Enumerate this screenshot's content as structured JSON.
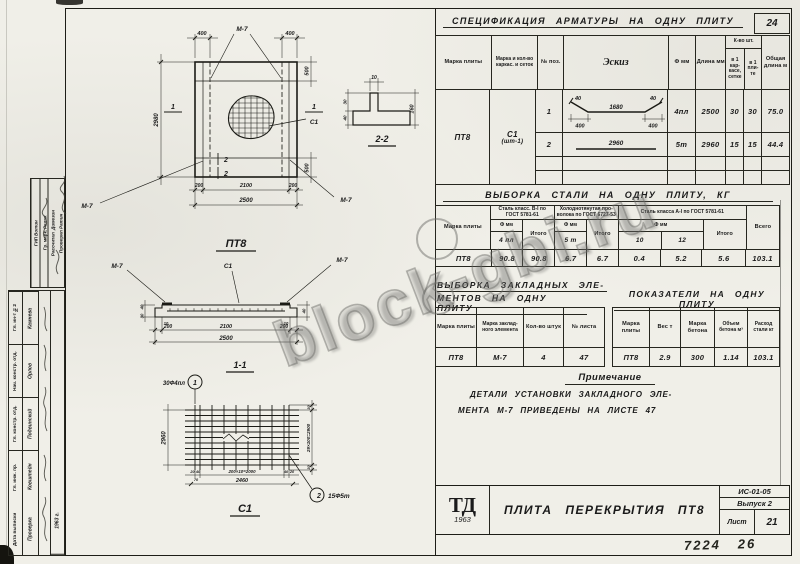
{
  "wm": "block-gbi.ru",
  "stamp": {
    "upper_cols": [
      {
        "label": "ГИП",
        "name": "Вотин"
      },
      {
        "label": "Гр. марк.",
        "name": "Релик"
      },
      {
        "label": "Рассчитал",
        "name": "Димезин"
      },
      {
        "label": "Проверил",
        "name": "Ратин"
      }
    ],
    "lower_labels": [
      "Гл. ин-т №2",
      "Нач. констр. отд.",
      "Гл. констр. отд.",
      "Гл. инж. пр.",
      "Дата выписки"
    ],
    "lower_names": [
      "Камнева",
      "Орлов",
      "Подвинский",
      "Ковштейн",
      "Проверка"
    ],
    "year": "1963 г."
  },
  "spec": {
    "title": "СПЕЦИФИКАЦИЯ  АРМАТУРЫ  НА  ОДНУ  ПЛИТУ",
    "corner": "24",
    "h_marka": "Марка плиты",
    "h_karkas": "Марка и кол-во каркас. и сеток",
    "h_poz": "№ поз.",
    "h_eskiz": "Эскиз",
    "h_f": "Ф мм",
    "h_dlina": "Длина мм",
    "h_kvo": "К-во шт.",
    "h_kvo1": "в 1 кар-касе, сетке",
    "h_kvo2": "в 1 пли-те",
    "h_total": "Общая длина м",
    "marka": "ПТ8",
    "karkas_line1": "С1",
    "karkas_line2": "(шт-1)",
    "rows": [
      {
        "poz": "1",
        "f": "4пл",
        "dlina": "2500",
        "in_karkas": "30",
        "in_plita": "30",
        "total": "75.0",
        "hook_l": "40",
        "hook_r": "40",
        "mid": "1680",
        "seg_l": "400",
        "seg_r": "400"
      },
      {
        "poz": "2",
        "f": "5т",
        "dlina": "2960",
        "in_karkas": "15",
        "in_plita": "15",
        "total": "44.4",
        "len": "2960"
      }
    ]
  },
  "steel": {
    "title": "ВЫБОРКА  СТАЛИ  НА  ОДНУ  ПЛИТУ,  КГ",
    "h_marka": "Марка плиты",
    "g1_label": "Сталь класс. В-I по ГОСТ 5781-61",
    "g2_label": "Холоднотянутая про-волока по ГОСТ 6727-53",
    "g3_label": "Сталь класса А-I по ГОСТ 5781-61",
    "h_f": "Ф мм",
    "h_itogo": "Итого",
    "h_vsego": "Всего",
    "g1_d1": "4 пл",
    "g2_d1": "5 т",
    "g3_d1": "10",
    "g3_d2": "12",
    "marka": "ПТ8",
    "g1_v1": "90.8",
    "g1_itogo": "90.8",
    "g2_v1": "6.7",
    "g2_itogo": "6.7",
    "g3_v1": "0.4",
    "g3_v2": "5.2",
    "g3_itogo": "5.6",
    "vsego": "103.1"
  },
  "embed": {
    "title1": "ВЫБОРКА  ЗАКЛАДНЫХ  ЭЛЕ-",
    "title2": "МЕНТОВ  НА  ОДНУ  ПЛИТУ",
    "h_marka": "Марка плиты",
    "h_elem": "Марка заклад-ного элемента",
    "h_qty": "Кол-во штук",
    "h_list": "№ листа",
    "marka": "ПТ8",
    "elem": "М-7",
    "qty": "4",
    "list": "47"
  },
  "ind": {
    "title": "ПОКАЗАТЕЛИ  НА  ОДНУ  ПЛИТУ",
    "h_marka": "Марка плиты",
    "h_ves": "Вес т",
    "h_beton": "Марка бетона",
    "h_vol": "Объем бетона м³",
    "h_steel": "Расход стали кг",
    "marka": "ПТ8",
    "ves": "2.9",
    "beton": "300",
    "vol": "1.14",
    "steel": "103.1"
  },
  "note": {
    "title": "Примечание",
    "line1": "ДЕТАЛИ  УСТАНОВКИ  ЗАКЛАДНОГО  ЭЛЕ-",
    "line2": "МЕНТА  М-7  ПРИВЕДЕНЫ  НА  ЛИСТЕ  47"
  },
  "tb": {
    "logo": "ТД",
    "year": "1963",
    "title": "ПЛИТА  ПЕРЕКРЫТИЯ  ПТ8",
    "doc": "ИС-01-05",
    "issue": "Выпуск 2",
    "sheet_label": "Лист",
    "sheet": "21"
  },
  "footer": {
    "number": "7224   26"
  },
  "dr": {
    "plan": {
      "title": "ПТ8",
      "m7": "М-7",
      "d400l": "400",
      "d400r": "400",
      "d2980": "2980",
      "d500t": "500",
      "d500b": "500",
      "d200l": "200",
      "d2100": "2100",
      "d200r": "200",
      "d2500": "2500",
      "s1": "1",
      "s2": "2",
      "c1": "С1"
    },
    "s22": {
      "title": "2-2",
      "d10": "10",
      "d30": "30",
      "d40": "40",
      "d160": "160"
    },
    "s11": {
      "title": "1-1",
      "m7": "М-7",
      "c1": "С1",
      "d40l": "40",
      "d30l": "30",
      "d10l": "10",
      "d10r": "10",
      "d200l": "200",
      "d2100": "2100",
      "d200r": "200",
      "d2500": "2500",
      "d40r": "40"
    },
    "mesh": {
      "title": "С1",
      "c1_text": "30Ф4пл",
      "c1_num": "1",
      "c2_text": "15Ф5т",
      "c2_num": "2",
      "d2960": "2960",
      "d30t": "30",
      "dmain": "29×100=2900",
      "d30b": "30",
      "d20l": "20",
      "d40l": "40",
      "dmid": "200×10=2000",
      "d40r": "40",
      "d20r": "20",
      "d70": "70",
      "d2460": "2460"
    }
  }
}
